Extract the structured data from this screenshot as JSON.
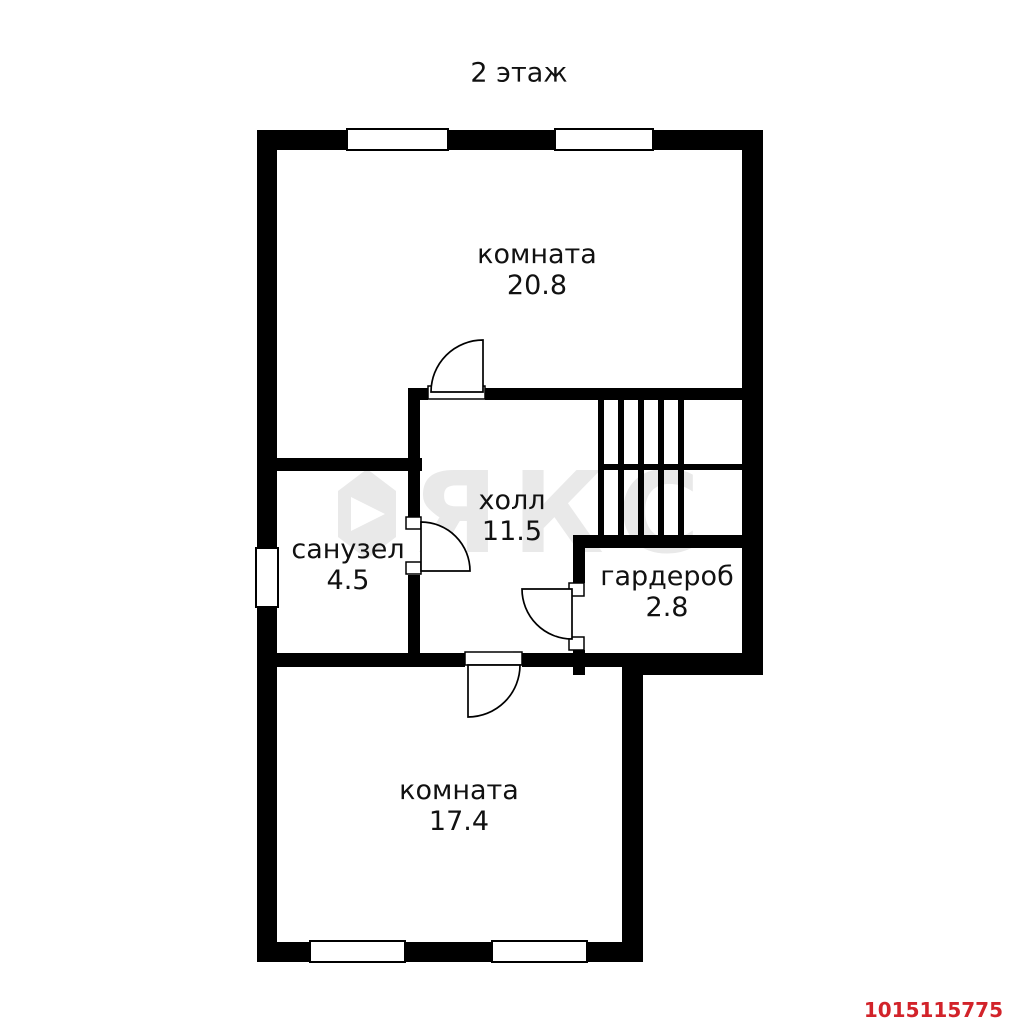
{
  "title": "2 этаж",
  "photo_id": "1015115775",
  "watermark": {
    "text": "ЯКС"
  },
  "colors": {
    "wall": "#000000",
    "floor": "#ffffff",
    "label_text": "#111111",
    "photo_id_red": "#d2232a",
    "watermark_gray": "#e9e9e9"
  },
  "rooms": [
    {
      "name": "комната",
      "area": "20.8"
    },
    {
      "name": "холл",
      "area": "11.5"
    },
    {
      "name": "санузел",
      "area": "4.5"
    },
    {
      "name": "гардероб",
      "area": "2.8"
    },
    {
      "name": "комната",
      "area": "17.4"
    }
  ]
}
